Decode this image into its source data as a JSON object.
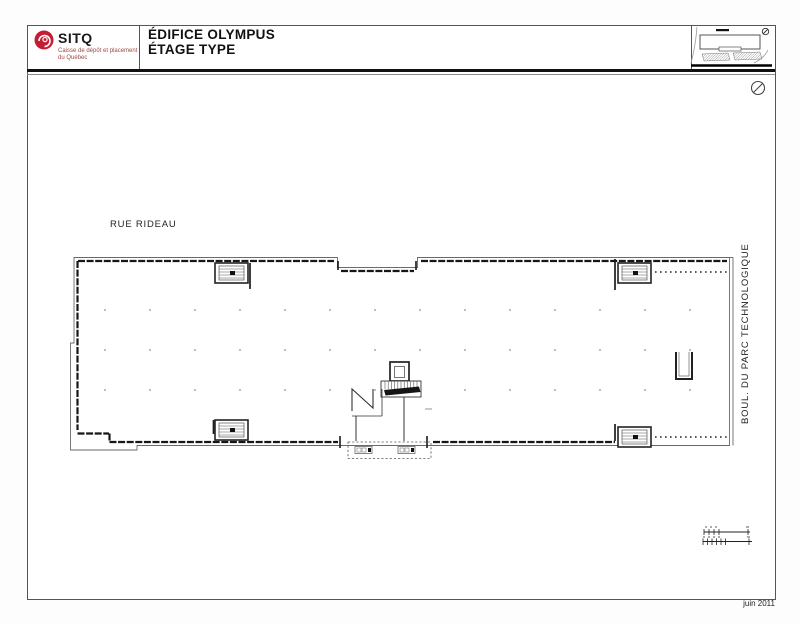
{
  "header": {
    "brand": {
      "name": "SITQ",
      "subtitle_line1": "Caisse de dépôt et placement",
      "subtitle_line2": "du Québec"
    },
    "title_line1": "ÉDIFICE OLYMPUS",
    "title_line2": "ÉTAGE TYPE"
  },
  "plan": {
    "street_top": "RUE RIDEAU",
    "street_right": "BOUL. DU PARC TECHNOLOGIQUE"
  },
  "footer": {
    "date": "juin 2011"
  },
  "icons": {
    "logo_mark": "red-swirl-circle",
    "north_arrow_icon": "circle-with-slash",
    "key_plan": "mini-site-plan",
    "graphic_scale": "tick-ruler"
  },
  "colors": {
    "brand_red": "#c41c33",
    "subtitle_red": "#9c4a44",
    "ink": "#1c1c1c",
    "wall_outer": "#6a6a6a",
    "grid_dot": "#b8b8b8"
  }
}
